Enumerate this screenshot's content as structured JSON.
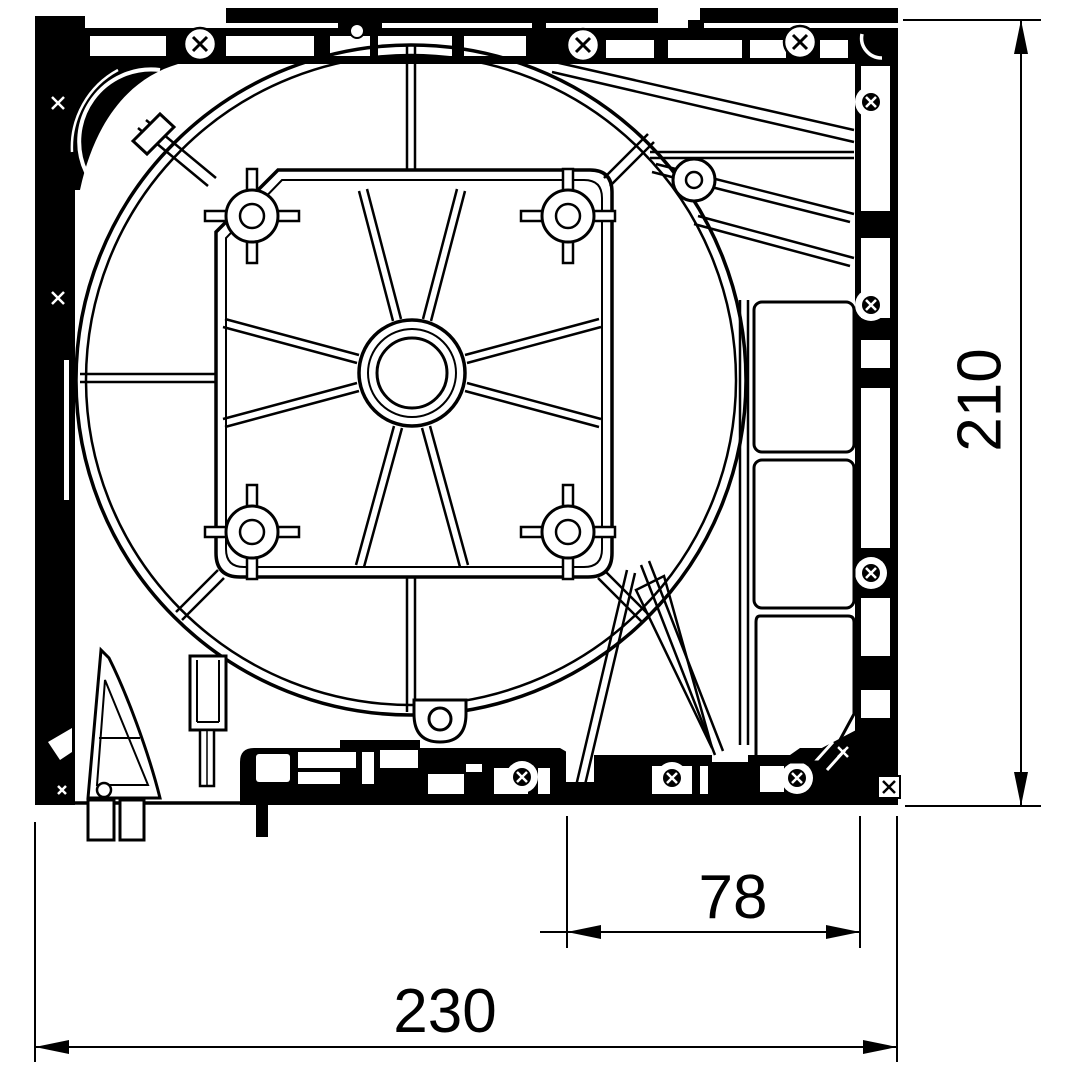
{
  "drawing": {
    "description": "Black-and-white CAD technical drawing: top view of a fan housing mounting frame with shroud circle, spoked hub, four screw bosses and extruded rails",
    "background_color": "#ffffff",
    "line_color": "#000000"
  },
  "dimensions": {
    "height": {
      "value": "210",
      "orientation": "vertical",
      "side": "right"
    },
    "mount_pitch": {
      "value": "78",
      "orientation": "horizontal",
      "side": "bottom"
    },
    "overall_width": {
      "value": "230",
      "orientation": "horizontal",
      "side": "bottom"
    }
  }
}
